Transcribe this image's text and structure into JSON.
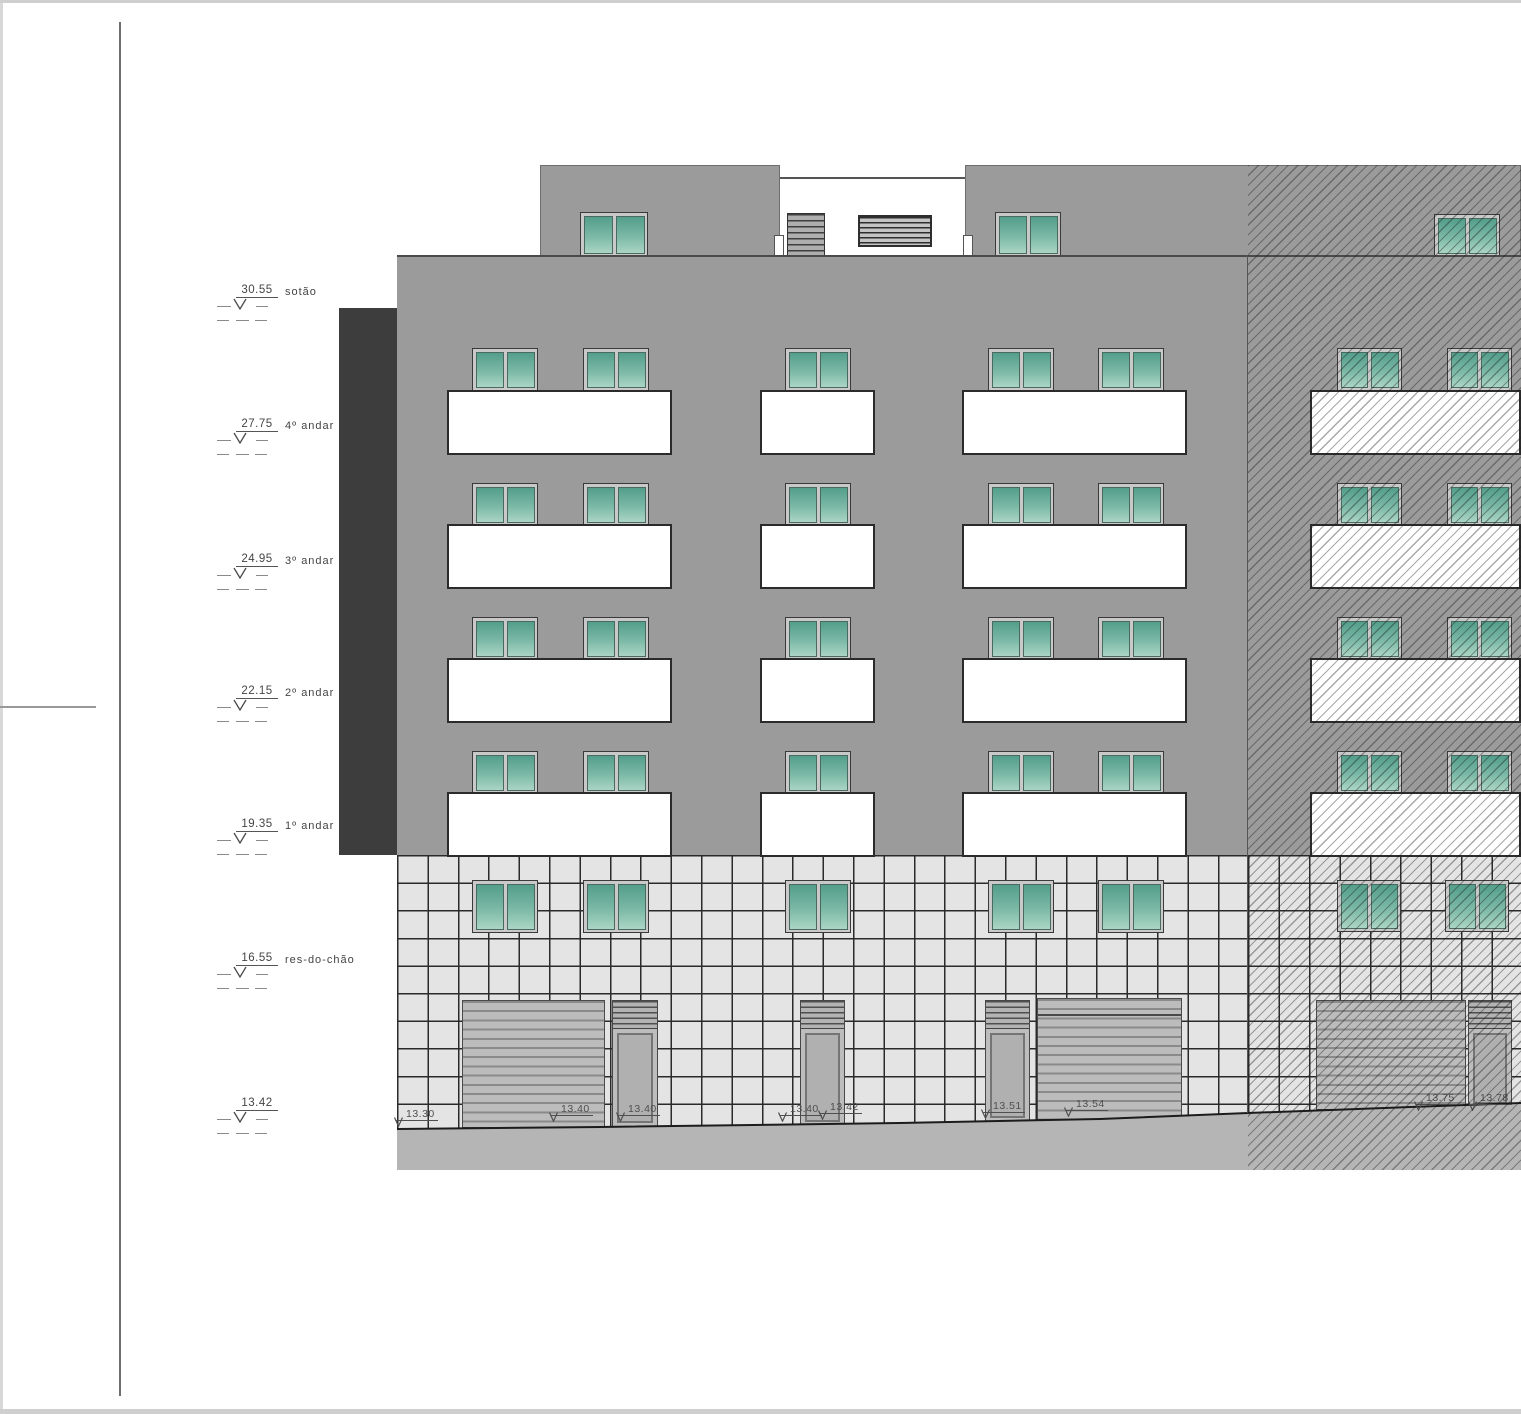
{
  "sheet": {
    "levels": [
      {
        "value": "30.55",
        "label": "sotão"
      },
      {
        "value": "27.75",
        "label": "4º andar"
      },
      {
        "value": "24.95",
        "label": "3º andar"
      },
      {
        "value": "22.15",
        "label": "2º andar"
      },
      {
        "value": "19.35",
        "label": "1º andar"
      },
      {
        "value": "16.55",
        "label": "res-do-chão"
      },
      {
        "value": "13.42",
        "label": ""
      }
    ],
    "spot_elevations": [
      "13.30",
      "13.40",
      "13.40",
      "13.40",
      "13.42",
      "13.51",
      "13.54",
      "13.75",
      "13.78"
    ],
    "colors": {
      "facade": "#9b9b9b",
      "side_wall": "#3d3d3d",
      "glass_top": "#539e8b",
      "glass_bottom": "#abd5c5",
      "tile": "#e4e4e4",
      "terrain": "#b5b5b5",
      "balcony": "#ffffff"
    }
  }
}
